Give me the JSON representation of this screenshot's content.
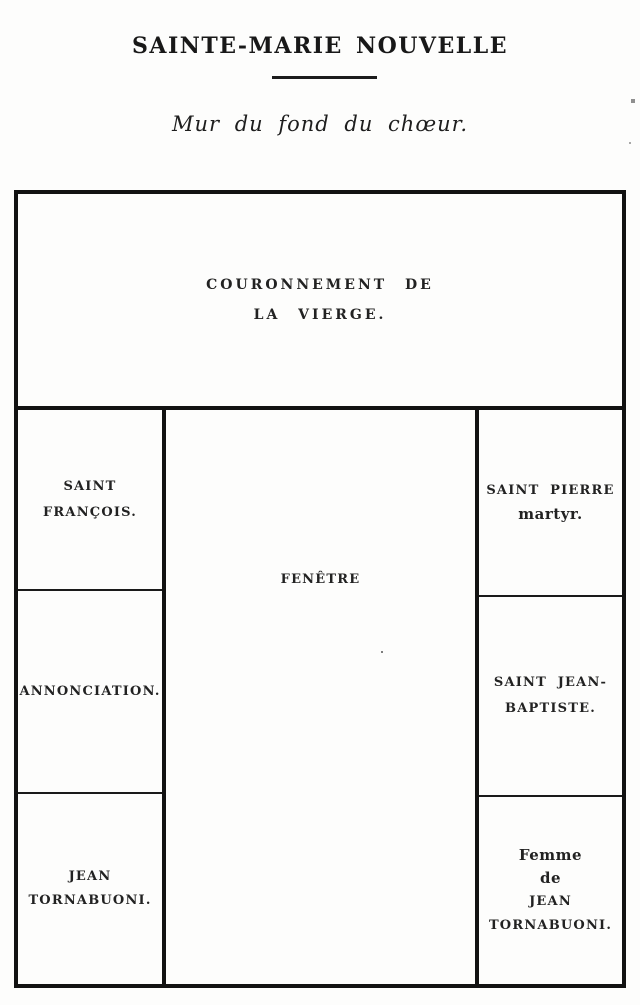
{
  "page": {
    "title": "SAINTE-MARIE NOUVELLE",
    "subtitle": "Mur du fond du chœur."
  },
  "diagram": {
    "top_panel": {
      "line1": "COURONNEMENT DE",
      "line2": "LA VIERGE."
    },
    "left_column": {
      "cell1": {
        "line1": "SAINT FRANÇOIS."
      },
      "cell2": {
        "line1": "ANNONCIATION."
      },
      "cell3": {
        "line1": "JEAN",
        "line2": "TORNABUONI."
      }
    },
    "center_column": {
      "label": "FENÊTRE"
    },
    "right_column": {
      "cell1": {
        "line1": "SAINT PIERRE",
        "line2": "martyr."
      },
      "cell2": {
        "line1": "SAINT JEAN-",
        "line2": "BAPTISTE."
      },
      "cell3": {
        "line1": "Femme",
        "line2": "de",
        "line3": "JEAN",
        "line4": "TORNABUONI."
      }
    }
  },
  "colors": {
    "ink": "#1b1b1b",
    "border": "#121212",
    "paper": "#fdfdfc"
  }
}
